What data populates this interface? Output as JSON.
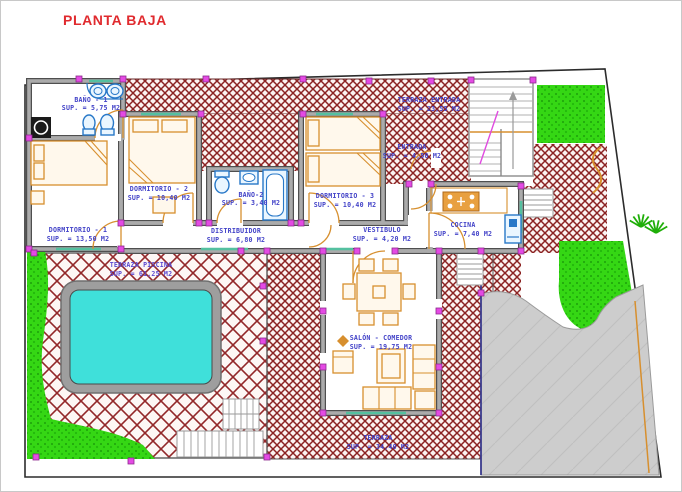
{
  "title": "PLANTA BAJA",
  "colors": {
    "title": "#e02a2e",
    "room_label": "#4343c8",
    "pool_label": "#5b4ad0",
    "hatch": "#8b2222",
    "green": "#35d714",
    "pool_water": "#3fe0da",
    "furniture": "#d78f2e",
    "fixture_blue": "#2878c8",
    "junction_marker": "#e44ae4",
    "driveway": "#cdcdcd",
    "wall": "#ababab"
  },
  "rooms": [
    {
      "id": "banyo1",
      "name": "BAÑO - 1",
      "sup": "SUP. = 5,75 M2"
    },
    {
      "id": "dormitorio1",
      "name": "DORMITORIO - 1",
      "sup": "SUP. = 13,50 M2"
    },
    {
      "id": "dormitorio2",
      "name": "DORMITORIO - 2",
      "sup": "SUP. = 10,40 M2"
    },
    {
      "id": "banyo2",
      "name": "BAÑO-2",
      "sup": "SUP. = 3,40 M2"
    },
    {
      "id": "distribuidor",
      "name": "DISTRIBUIDOR",
      "sup": "SUP. = 6,80 M2"
    },
    {
      "id": "dormitorio3",
      "name": "DORMITORIO - 3",
      "sup": "SUP. = 10,40 M2"
    },
    {
      "id": "entrada",
      "name": "ENTRADA",
      "sup": "SUP. = 4,50 M2"
    },
    {
      "id": "terraza-entrada",
      "name": "TERRAZA ENTRADA",
      "sup": "SUP. = 23,55 M2"
    },
    {
      "id": "vestibulo",
      "name": "VESTIBULO",
      "sup": "SUP. = 4,20 M2"
    },
    {
      "id": "cocina",
      "name": "COCINA",
      "sup": "SUP. = 7,40 M2"
    },
    {
      "id": "salon-comedor",
      "name": "SALÓN - COMEDOR",
      "sup": "SUP. = 19,75 M2"
    },
    {
      "id": "terraza",
      "name": "TERRAZA",
      "sup": "SUP. = 34,40 M2"
    },
    {
      "id": "terraza-piscina",
      "name": "TERRAZA PISCINA",
      "sup": "SUP. = 61,25 M2"
    }
  ]
}
